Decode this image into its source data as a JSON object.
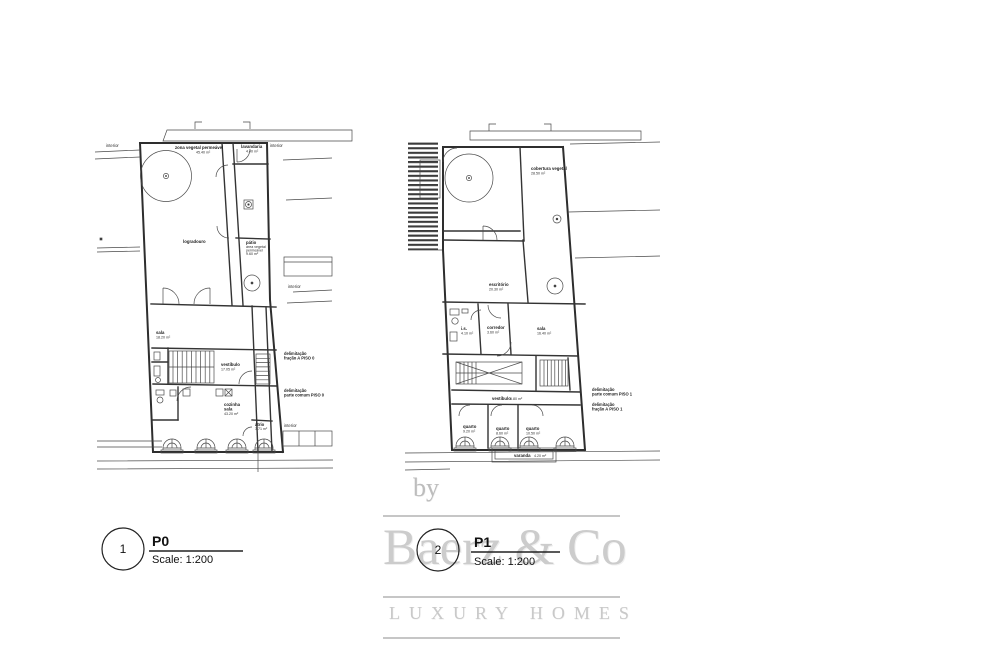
{
  "sheet": {
    "background": "#ffffff",
    "line_color": "#2e2e2e"
  },
  "watermark": {
    "by": "by",
    "brand": "Baerz & Co",
    "tagline": "LUXURY HOMES",
    "color": "#c9c9c9"
  },
  "title_blocks": {
    "p0": {
      "number": "1",
      "code": "P0",
      "scale": "Scale: 1:200"
    },
    "p1": {
      "number": "2",
      "code": "P1",
      "scale": "Scale: 1:200"
    }
  },
  "plan_p0": {
    "name": "floor-plan-piso-0",
    "labels": {
      "interior": "interior",
      "zona_vegetal": "zona vegetal permeável",
      "zona_vegetal_area": "45.40 m²",
      "lavandaria": "lavandaria",
      "lavandaria_area": "4.40 m²",
      "logradouro": "logradouro",
      "patio": "pátio",
      "patio_sub1": "área vegetal",
      "patio_sub2": "permeável",
      "patio_area": "9.60 m²",
      "sala": "sala",
      "sala_area": "18.20 m²",
      "vestibulo": "vestíbulo",
      "vestibulo_area": "17.05 m²",
      "cozinha_l1": "cozinha",
      "cozinha_l2": "sala",
      "cozinha_area": "43.20 m²",
      "atrio": "átrio",
      "atrio_area": "3.71 m²",
      "delim_fracao_l1": "delimitação",
      "delim_fracao_l2": "fração A PISO 0",
      "delim_comum_l1": "delimitação",
      "delim_comum_l2": "parte comum PISO 0"
    }
  },
  "plan_p1": {
    "name": "floor-plan-piso-1",
    "labels": {
      "cobertura": "cobertura vegetal",
      "cobertura_area": "28.50 m²",
      "escritorio": "escritório",
      "escritorio_area": "20.30 m²",
      "is": "i.s.",
      "is_area": "4.10 m²",
      "corredor": "corredor",
      "corredor_area": "3.60 m²",
      "sala": "sala",
      "sala_area": "16.40 m²",
      "vestibulo": "vestíbulo",
      "vestibulo_area": "5.80 m²",
      "quarto1": "quarto",
      "quarto1_area": "9.20 m²",
      "quarto2": "quarto",
      "quarto2_area": "8.60 m²",
      "quarto3": "quarto",
      "quarto3_area": "10.50 m²",
      "varanda": "varanda",
      "varanda_area": "4.20 m²",
      "delim_comum_l1": "delimitação",
      "delim_comum_l2": "parte comum PISO 1",
      "delim_fracao_l1": "delimitação",
      "delim_fracao_l2": "fração A PISO 1"
    }
  }
}
